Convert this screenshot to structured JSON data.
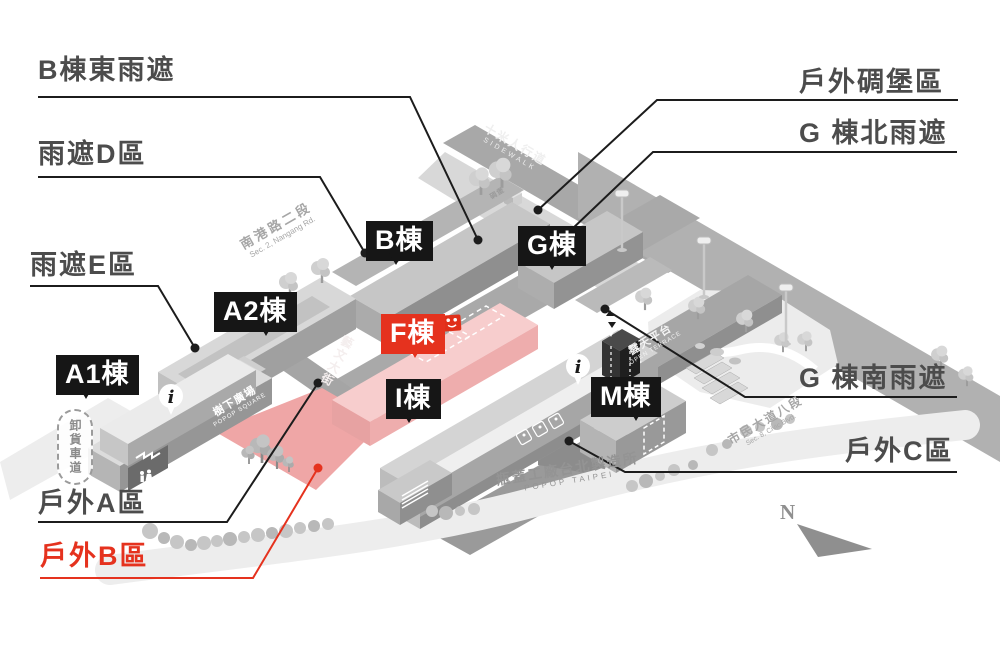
{
  "colors": {
    "accent_red": "#e5321e",
    "tag_black": "#161616",
    "callout_gray": "#4c4c4c"
  },
  "tags": {
    "a1": "A1棟",
    "a2": "A2棟",
    "b": "B棟",
    "g": "G棟",
    "f": "F棟",
    "i": "I棟",
    "m": "M棟"
  },
  "callouts": {
    "b_east": "B棟東雨遮",
    "rain_d": "雨遮D區",
    "rain_e": "雨遮E區",
    "bunker_zone": "戶外碉堡區",
    "g_north": "G 棟北雨遮",
    "g_south": "G 棟南雨遮",
    "out_c": "戶外C區",
    "out_a": "戶外A區",
    "out_b": "戶外B區"
  },
  "roads": {
    "sidewalk_zh": "十米人行道",
    "sidewalk_en": "SIDEWALK",
    "nangang_zh": "南港路二段",
    "nangang_en": "Sec. 2, Nangang Rd.",
    "yiwen": "藝文大街",
    "civic_zh": "市民大道八段",
    "civic_en": "Sec. 8, Civic Blvd.",
    "unloading": "卸貨車道"
  },
  "zones": {
    "square_zh": "樹下廣場",
    "square_en": "POPOP SQUARE",
    "terrace_zh": "露天平台",
    "terrace_en": "OPEN TERRACE",
    "bunker": "碉堡"
  },
  "footer": {
    "factory_zh": "瓶蓋工廠台北製造所",
    "factory_en": "POPOP TAIPEI"
  },
  "compass": {
    "north": "N"
  },
  "icons": {
    "info": "i"
  }
}
